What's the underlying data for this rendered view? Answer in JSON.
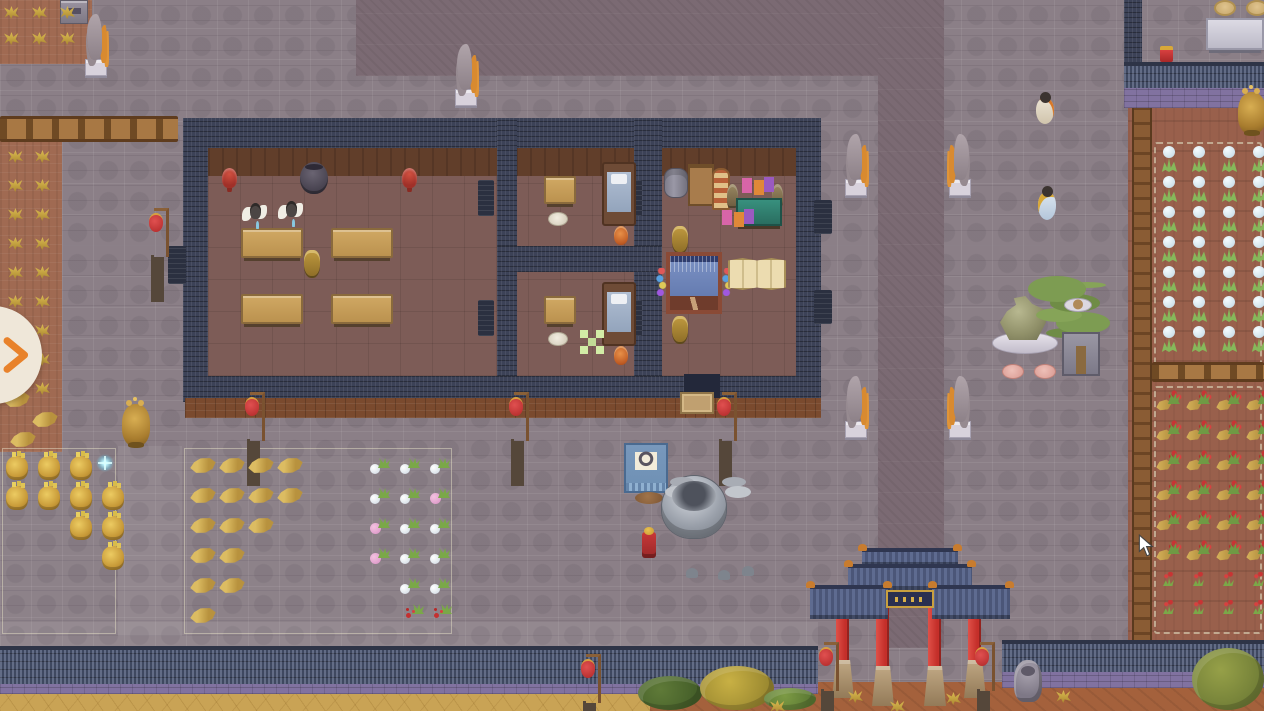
{
  "meta": {
    "app": "top-down pixel-art management game (temple courtyard scene)",
    "viewport": {
      "width": 1264,
      "height": 711
    },
    "visible_text": "none"
  },
  "palette": {
    "tile": "#8b7f87",
    "path": "#7b6a73",
    "wall_navy": "#3c4257",
    "wall_roof": "#4d5875",
    "brick_purple": "#8172a0",
    "floor": "#7d5c57",
    "floor_top": "#613e2a",
    "soil_west": "#a06a52",
    "soil_east": "#99604c",
    "sand": "#c9a355",
    "dirt": "#a4613c",
    "lantern_red": "#b02828",
    "pillar_red": "#c42f2a",
    "table_tan": "#d0a863",
    "teal": "#2a6e60",
    "gold": "#d8a83c",
    "banner_blue": "#7898bc",
    "bonsai_green": "#7d9c52",
    "marker_green": "#d2eca6",
    "accent_orange": "#e8822b"
  },
  "ui": {
    "expand_panel_button": {
      "icon": "chevron-right",
      "color": "#e8822b"
    },
    "mouse_cursor": {
      "icon": "arrow",
      "color": "#ffffff"
    }
  },
  "scene": {
    "regions": [
      "courtyard-stone-tiles",
      "dark-stone-path-vertical",
      "dark-stone-patch-north",
      "farm-plot-northwest",
      "farm-plot-west",
      "farm-plot-east",
      "main-hall-building",
      "south-perimeter-wall",
      "northeast-wall",
      "gate-paifang",
      "sand-strip-south",
      "dirt-strip-southeast",
      "grain-stockpile-zone",
      "herb-stockpile-zone"
    ],
    "entities": [
      {
        "t": "stone-basin",
        "n": "stone-offering-table",
        "x": 60,
        "y": 0
      },
      {
        "t": "crane-statue",
        "n": "crane-statue-northwest",
        "x": 82,
        "y": 14
      },
      {
        "t": "crane-statue",
        "n": "crane-statue-courtyard-top",
        "x": 452,
        "y": 44
      },
      {
        "t": "crane-statue",
        "n": "crane-statue-path-upper-left",
        "x": 842,
        "y": 134
      },
      {
        "t": "crane-statue",
        "cls": "flip",
        "n": "crane-statue-path-upper-right",
        "x": 948,
        "y": 134
      },
      {
        "t": "crane-statue",
        "n": "crane-statue-path-lower-left",
        "x": 842,
        "y": 376
      },
      {
        "t": "crane-statue",
        "cls": "flip",
        "n": "crane-statue-path-lower-right",
        "x": 948,
        "y": 376
      },
      {
        "t": "gold-urn",
        "n": "golden-incense-burner-west",
        "x": 122,
        "y": 404
      },
      {
        "t": "gold-urn",
        "n": "golden-incense-burner-northeast",
        "x": 1238,
        "y": 92
      },
      {
        "t": "stone-lion",
        "n": "stone-lion-statue",
        "x": 1014,
        "y": 660
      },
      {
        "t": "lantern-pole",
        "n": "red-lantern-west",
        "x": 148,
        "y": 206
      },
      {
        "t": "lantern-pole",
        "n": "red-lantern-porch-left",
        "x": 244,
        "y": 390
      },
      {
        "t": "lantern-pole",
        "n": "red-lantern-porch-middle",
        "x": 508,
        "y": 390
      },
      {
        "t": "lantern-pole",
        "n": "red-lantern-porch-right",
        "x": 716,
        "y": 390
      },
      {
        "t": "lantern-pole",
        "n": "red-lantern-south-wall",
        "x": 580,
        "y": 652
      },
      {
        "t": "lantern-pole",
        "n": "red-lantern-gate-left",
        "x": 818,
        "y": 640
      },
      {
        "t": "lantern-pole",
        "n": "red-lantern-gate-right",
        "x": 974,
        "y": 640
      },
      {
        "t": "red-stool",
        "n": "red-altar-stool-left",
        "x": 222,
        "y": 168
      },
      {
        "t": "red-stool",
        "n": "red-altar-stool-right",
        "x": 402,
        "y": 168
      },
      {
        "t": "urn-dark",
        "n": "large-dark-urn",
        "x": 300,
        "y": 162
      },
      {
        "t": "table-long",
        "n": "dining-table-1",
        "x": 241,
        "y": 228
      },
      {
        "t": "table-long",
        "n": "dining-table-2",
        "x": 331,
        "y": 228
      },
      {
        "t": "table-long",
        "n": "dining-table-3",
        "x": 241,
        "y": 294
      },
      {
        "t": "table-long",
        "n": "dining-table-4",
        "x": 331,
        "y": 294
      },
      {
        "t": "incense-bronze",
        "n": "hall-incense-burner",
        "x": 304,
        "y": 250
      },
      {
        "t": "person-white",
        "n": "disciple-1",
        "x": 242,
        "y": 202
      },
      {
        "t": "person-white",
        "n": "disciple-2",
        "x": 278,
        "y": 200
      },
      {
        "t": "table-square",
        "n": "bedroom1-table",
        "x": 544,
        "y": 176
      },
      {
        "t": "cushion-round",
        "n": "bedroom1-cushion",
        "x": 548,
        "y": 212
      },
      {
        "t": "bed",
        "n": "bedroom1-bed",
        "x": 602,
        "y": 162
      },
      {
        "t": "orange-vase",
        "n": "bedroom1-vase",
        "x": 614,
        "y": 226
      },
      {
        "t": "table-square",
        "n": "bedroom2-table",
        "x": 544,
        "y": 296
      },
      {
        "t": "cushion-round",
        "n": "bedroom2-cushion",
        "x": 548,
        "y": 332
      },
      {
        "t": "bed",
        "n": "bedroom2-bed",
        "x": 602,
        "y": 282
      },
      {
        "t": "orange-vase",
        "n": "bedroom2-vase",
        "x": 614,
        "y": 346
      },
      {
        "t": "green-marker",
        "n": "placement-marker",
        "x": 580,
        "y": 330,
        "i": false
      },
      {
        "t": "barrel-gray",
        "n": "storage-barrel",
        "x": 664,
        "y": 168
      },
      {
        "t": "shelf-wood",
        "n": "storage-shelf",
        "x": 688,
        "y": 164
      },
      {
        "t": "awning-stand",
        "n": "striped-stand",
        "x": 712,
        "y": 168
      },
      {
        "t": "bronze-statuette",
        "n": "statuette-left",
        "x": 727,
        "y": 184
      },
      {
        "t": "bronze-statuette",
        "n": "statuette-right",
        "x": 772,
        "y": 184
      },
      {
        "t": "workbench-teal",
        "n": "workbench",
        "x": 736,
        "y": 198
      },
      {
        "t": "goods",
        "n": "stacked-goods-upper",
        "x": 742,
        "y": 178
      },
      {
        "t": "goods",
        "n": "stacked-goods-lower",
        "x": 722,
        "y": 210
      },
      {
        "t": "incense-bronze",
        "n": "loom-incense-upper",
        "x": 672,
        "y": 226
      },
      {
        "t": "loom",
        "n": "weaving-loom",
        "x": 666,
        "y": 252
      },
      {
        "t": "spools",
        "n": "thread-spools-left",
        "x": 656,
        "y": 268
      },
      {
        "t": "spools",
        "n": "thread-spools-right",
        "x": 722,
        "y": 268
      },
      {
        "t": "folding-screen",
        "n": "folding-screen",
        "x": 728,
        "y": 258
      },
      {
        "t": "incense-bronze",
        "n": "loom-incense-lower",
        "x": 672,
        "y": 316
      },
      {
        "t": "doormat",
        "n": "entrance-doormat",
        "x": 680,
        "y": 392
      },
      {
        "t": "banner-stand",
        "n": "target-banner-stand",
        "x": 620,
        "y": 438
      },
      {
        "t": "cauldron",
        "n": "great-bronze-cauldron",
        "x": 658,
        "y": 466
      },
      {
        "t": "incense-red",
        "n": "red-incense-stand",
        "x": 642,
        "y": 532
      },
      {
        "t": "rock-dish",
        "n": "scholar-rock-dish",
        "x": 992,
        "y": 296
      },
      {
        "t": "bonsai",
        "n": "bonsai-tree",
        "x": 1028,
        "y": 276
      },
      {
        "t": "plate-small",
        "n": "offering-plate",
        "x": 1064,
        "y": 298
      },
      {
        "t": "cushion-pink",
        "n": "pink-cushion-left",
        "x": 1002,
        "y": 364
      },
      {
        "t": "cushion-pink",
        "n": "pink-cushion-right",
        "x": 1034,
        "y": 364
      },
      {
        "t": "cushion-tan",
        "n": "round-cushion-left",
        "x": 1214,
        "y": 0
      },
      {
        "t": "cushion-tan",
        "n": "round-cushion-right",
        "x": 1246,
        "y": 0
      },
      {
        "t": "white-table",
        "n": "stone-table-northeast",
        "x": 1206,
        "y": 18
      },
      {
        "t": "red-gold-box",
        "n": "red-chest",
        "x": 1160,
        "y": 46
      },
      {
        "t": "person-cream",
        "n": "villager-north",
        "x": 1032,
        "y": 92
      },
      {
        "t": "person-blue",
        "n": "villager-east",
        "x": 1034,
        "y": 186
      },
      {
        "t": "sparkle",
        "n": "sparkle-effect",
        "x": 96,
        "y": 454,
        "i": false
      },
      {
        "t": "wheat-sheaf",
        "n": "dry-leaf-pile",
        "x": 4,
        "y": 392
      },
      {
        "t": "wheat-sheaf",
        "n": "dry-leaf-pile",
        "x": 32,
        "y": 412
      },
      {
        "t": "wheat-sheaf",
        "n": "dry-leaf-pile",
        "x": 10,
        "y": 432
      },
      {
        "t": "pink-flower-cut",
        "n": "cut-pink-flower",
        "x": 430,
        "y": 488
      },
      {
        "t": "pink-flower-cut",
        "n": "cut-pink-flower",
        "x": 370,
        "y": 518
      },
      {
        "t": "pink-flower-cut",
        "n": "cut-pink-flower",
        "x": 370,
        "y": 548
      },
      {
        "t": "red-plant-cut",
        "n": "cut-red-flower",
        "x": 404,
        "y": 604
      },
      {
        "t": "red-plant-cut",
        "n": "cut-red-flower",
        "x": 432,
        "y": 604
      },
      {
        "t": "foliage",
        "cls": "pine",
        "n": "pine-canopy",
        "x": 638,
        "y": 676,
        "w": 64,
        "h": 34
      },
      {
        "t": "foliage",
        "cls": "gold",
        "n": "golden-tree-canopy",
        "x": 700,
        "y": 666,
        "w": 74,
        "h": 44
      },
      {
        "t": "foliage",
        "cls": "green",
        "n": "shrub-canopy",
        "x": 764,
        "y": 688,
        "w": 52,
        "h": 22
      },
      {
        "t": "foliage",
        "cls": "olive",
        "n": "olive-tree-canopy",
        "x": 1192,
        "y": 648,
        "w": 72,
        "h": 62
      },
      {
        "t": "yellow-tuft",
        "n": "grass-tuft",
        "x": 848,
        "y": 690
      },
      {
        "t": "yellow-tuft",
        "n": "grass-tuft",
        "x": 890,
        "y": 700
      },
      {
        "t": "yellow-tuft",
        "n": "grass-tuft",
        "x": 946,
        "y": 692
      },
      {
        "t": "yellow-tuft",
        "n": "grass-tuft",
        "x": 1056,
        "y": 690
      },
      {
        "t": "yellow-tuft",
        "n": "grass-tuft",
        "x": 770,
        "y": 700
      },
      {
        "t": "gold-sack",
        "n": "grain-sack",
        "grid": {
          "x": 6,
          "y": 456,
          "dx": 32,
          "dy": 30,
          "cols": 4,
          "rows": 4
        },
        "skip": [
          "0,3",
          "2,0",
          "2,1",
          "3,0",
          "3,1",
          "3,2"
        ]
      },
      {
        "t": "wheat-sheaf",
        "n": "harvest-sheaf",
        "grid": {
          "x": 190,
          "y": 458,
          "dx": 29,
          "dy": 30,
          "cols": 4,
          "rows": 6
        },
        "skip": [
          "2,3",
          "3,2",
          "3,3",
          "4,2",
          "4,3",
          "5,1",
          "5,2",
          "5,3"
        ]
      },
      {
        "t": "white-flower-cut",
        "n": "cut-white-flower",
        "grid": {
          "x": 370,
          "y": 458,
          "dx": 30,
          "dy": 30,
          "cols": 3,
          "rows": 5
        },
        "skip": [
          "1,2",
          "2,0",
          "3,0",
          "4,0"
        ]
      },
      {
        "t": "yellow-tuft",
        "n": "millet-crop",
        "grid": {
          "x": 8,
          "y": 150,
          "dx": 27,
          "dy": 29,
          "cols": 2,
          "rows": 9
        }
      },
      {
        "t": "yellow-tuft",
        "n": "millet-crop",
        "grid": {
          "x": 4,
          "y": 6,
          "dx": 28,
          "dy": 26,
          "cols": 3,
          "rows": 2
        }
      },
      {
        "t": "white-flower-plant",
        "n": "white-flower-crop",
        "grid": {
          "x": 1160,
          "y": 146,
          "dx": 30,
          "dy": 30,
          "cols": 4,
          "rows": 7
        }
      },
      {
        "t": "red-flower-plant",
        "n": "red-flower-crop",
        "grid": {
          "x": 1156,
          "y": 390,
          "dx": 30,
          "dy": 30,
          "cols": 4,
          "rows": 6
        }
      },
      {
        "t": "red-sprout",
        "n": "red-flower-seedling",
        "grid": {
          "x": 1162,
          "y": 572,
          "dx": 30,
          "dy": 28,
          "cols": 4,
          "rows": 2
        }
      }
    ]
  }
}
